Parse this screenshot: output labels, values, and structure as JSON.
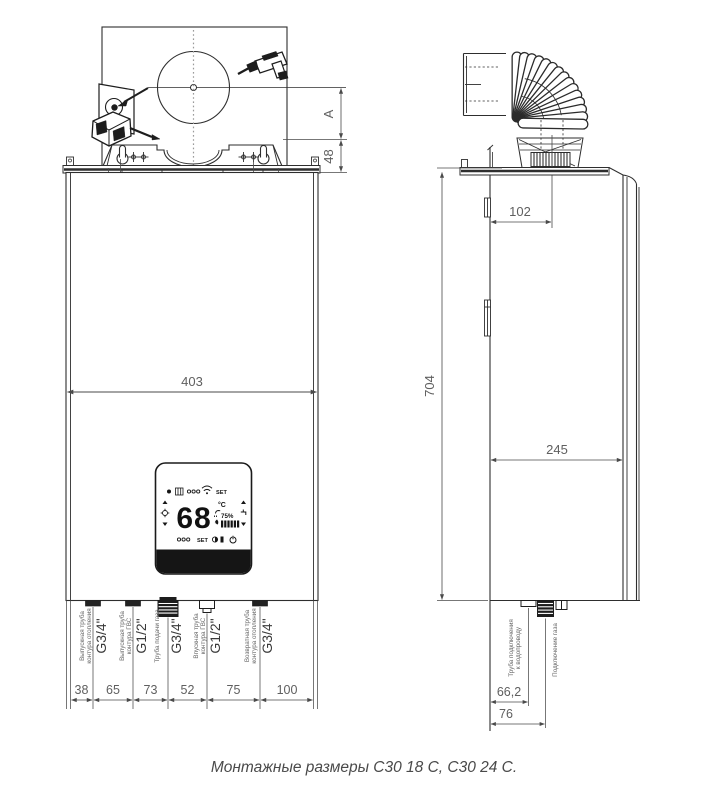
{
  "caption": "Монтажные размеры С30 18 С, С30 24 С.",
  "front": {
    "dim_a": "A",
    "dim_48": "48",
    "dim_195": "195",
    "dim_229": "229",
    "dim_403": "403",
    "bottom_dims": [
      "38",
      "65",
      "73",
      "52",
      "75",
      "100"
    ],
    "pipes": [
      {
        "line1": "Выпускная труба",
        "line2": "контура отопления",
        "size": "G3/4\""
      },
      {
        "line1": "Выпускная труба",
        "line2": "контура ГВС",
        "size": "G1/2\""
      },
      {
        "line1": "Труба подачи газа",
        "size": "G3/4\""
      },
      {
        "line1": "Впускная труба",
        "line2": "контура ГВС",
        "size": "G1/2\""
      },
      {
        "line1": "Возвратная труба",
        "line2": "контура отопления",
        "size": "G3/4\""
      }
    ]
  },
  "side": {
    "dim_102": "102",
    "dim_704": "704",
    "dim_245": "245",
    "dim_66_2": "66,2",
    "dim_76": "76",
    "water_label": {
      "line1": "Труба подключения",
      "line2": "к водопроводу"
    },
    "gas_label": "Подключение газа"
  },
  "display": {
    "temp": "68",
    "unit": "°C",
    "percent": "75%",
    "set_top": "SET",
    "set_bottom": "SET"
  },
  "icons": {
    "drill": "drill-icon",
    "wall_anchor": "wall-anchor-icon",
    "wifi": "wifi-icon",
    "flame": "flame-icon",
    "power": "power-icon",
    "radiator": "radiator-icon",
    "sun": "sun-icon",
    "shower": "shower-icon",
    "tap": "tap-icon"
  },
  "colors": {
    "line": "#2e2e2e",
    "dim": "#4a4a4a",
    "lcd": "#161616"
  }
}
